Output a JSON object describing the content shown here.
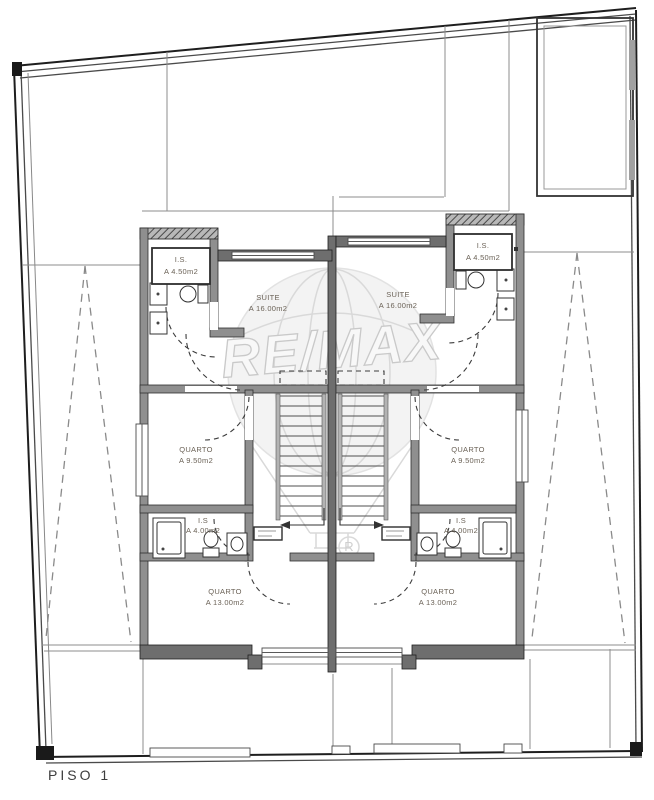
{
  "plan": {
    "floor_label": "PISO 1",
    "watermark": {
      "text": "RE/MAX",
      "registered": "R"
    },
    "units": [
      {
        "id": "left",
        "rooms": [
          {
            "label": "I.S.",
            "area": "A 4.50m2"
          },
          {
            "label": "SUITE",
            "area": "A 16.00m2"
          },
          {
            "label": "QUARTO",
            "area": "A 9.50m2"
          },
          {
            "label": "I.S",
            "area": "A 4.00m2"
          },
          {
            "label": "QUARTO",
            "area": "A 13.00m2"
          }
        ]
      },
      {
        "id": "right",
        "rooms": [
          {
            "label": "I.S.",
            "area": "A 4.50m2"
          },
          {
            "label": "SUITE",
            "area": "A 16.00m2"
          },
          {
            "label": "QUARTO",
            "area": "A 9.50m2"
          },
          {
            "label": "I.S",
            "area": "A 4.00m2"
          },
          {
            "label": "QUARTO",
            "area": "A 13.00m2"
          }
        ]
      }
    ]
  },
  "colors": {
    "background": "#ffffff",
    "wall": "#8f8f8f",
    "wall_dark": "#6e6e6e",
    "line": "#2e2e2e",
    "label_text": "#6b6257",
    "watermark": "#d9d9d9"
  }
}
